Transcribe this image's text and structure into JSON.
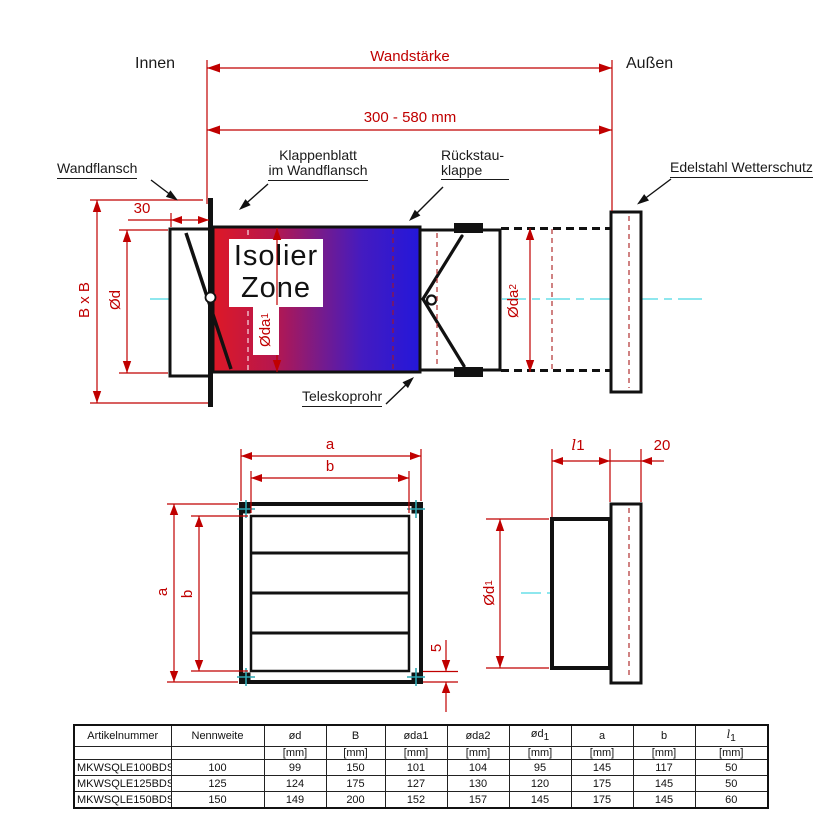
{
  "labels": {
    "innen": "Innen",
    "wandstaerke": "Wandstärke",
    "aussen": "Außen",
    "range": "300 - 580 mm",
    "wandflansch": "Wandflansch",
    "klappenblatt_line1": "Klappenblatt",
    "klappenblatt_line2": "im Wandflansch",
    "rueckstau_line1": "Rückstau-",
    "rueckstau_line2": "klappe",
    "edelstahl": "Edelstahl Wetterschutz",
    "isolier_line1": "Isolier",
    "isolier_line2": "Zone",
    "teleskoprohr": "Teleskoprohr"
  },
  "dims": {
    "d30": "30",
    "bxb": "B x B",
    "od": "Ød",
    "oda_base": "Øda",
    "sub1": "1",
    "sub2": "2",
    "a": "a",
    "b": "b",
    "five": "5",
    "ell": "l",
    "twenty": "20"
  },
  "colors": {
    "dimension_red": "#c00000",
    "centerline_cyan": "#8ee7ee",
    "corner_cross_teal": "#2fa8b4",
    "gradient_left_red": "#de1826",
    "gradient_right_blue": "#2417da",
    "line_black": "#1a1a1a"
  },
  "table": {
    "col_headers": [
      "Artikelnummer",
      "Nennweite",
      "ød",
      "B",
      "øda1",
      "øda2",
      "ød",
      "a",
      "b",
      "l"
    ],
    "col_header_subs": [
      "",
      "",
      "",
      "",
      "",
      "",
      "1",
      "",
      "",
      "1"
    ],
    "unit": "[mm]",
    "rows": [
      [
        "MKWSQLE100BDSI",
        "100",
        "99",
        "150",
        "101",
        "104",
        "95",
        "145",
        "117",
        "50"
      ],
      [
        "MKWSQLE125BDSI",
        "125",
        "124",
        "175",
        "127",
        "130",
        "120",
        "175",
        "145",
        "50"
      ],
      [
        "MKWSQLE150BDSI",
        "150",
        "149",
        "200",
        "152",
        "157",
        "145",
        "175",
        "145",
        "60"
      ]
    ]
  }
}
